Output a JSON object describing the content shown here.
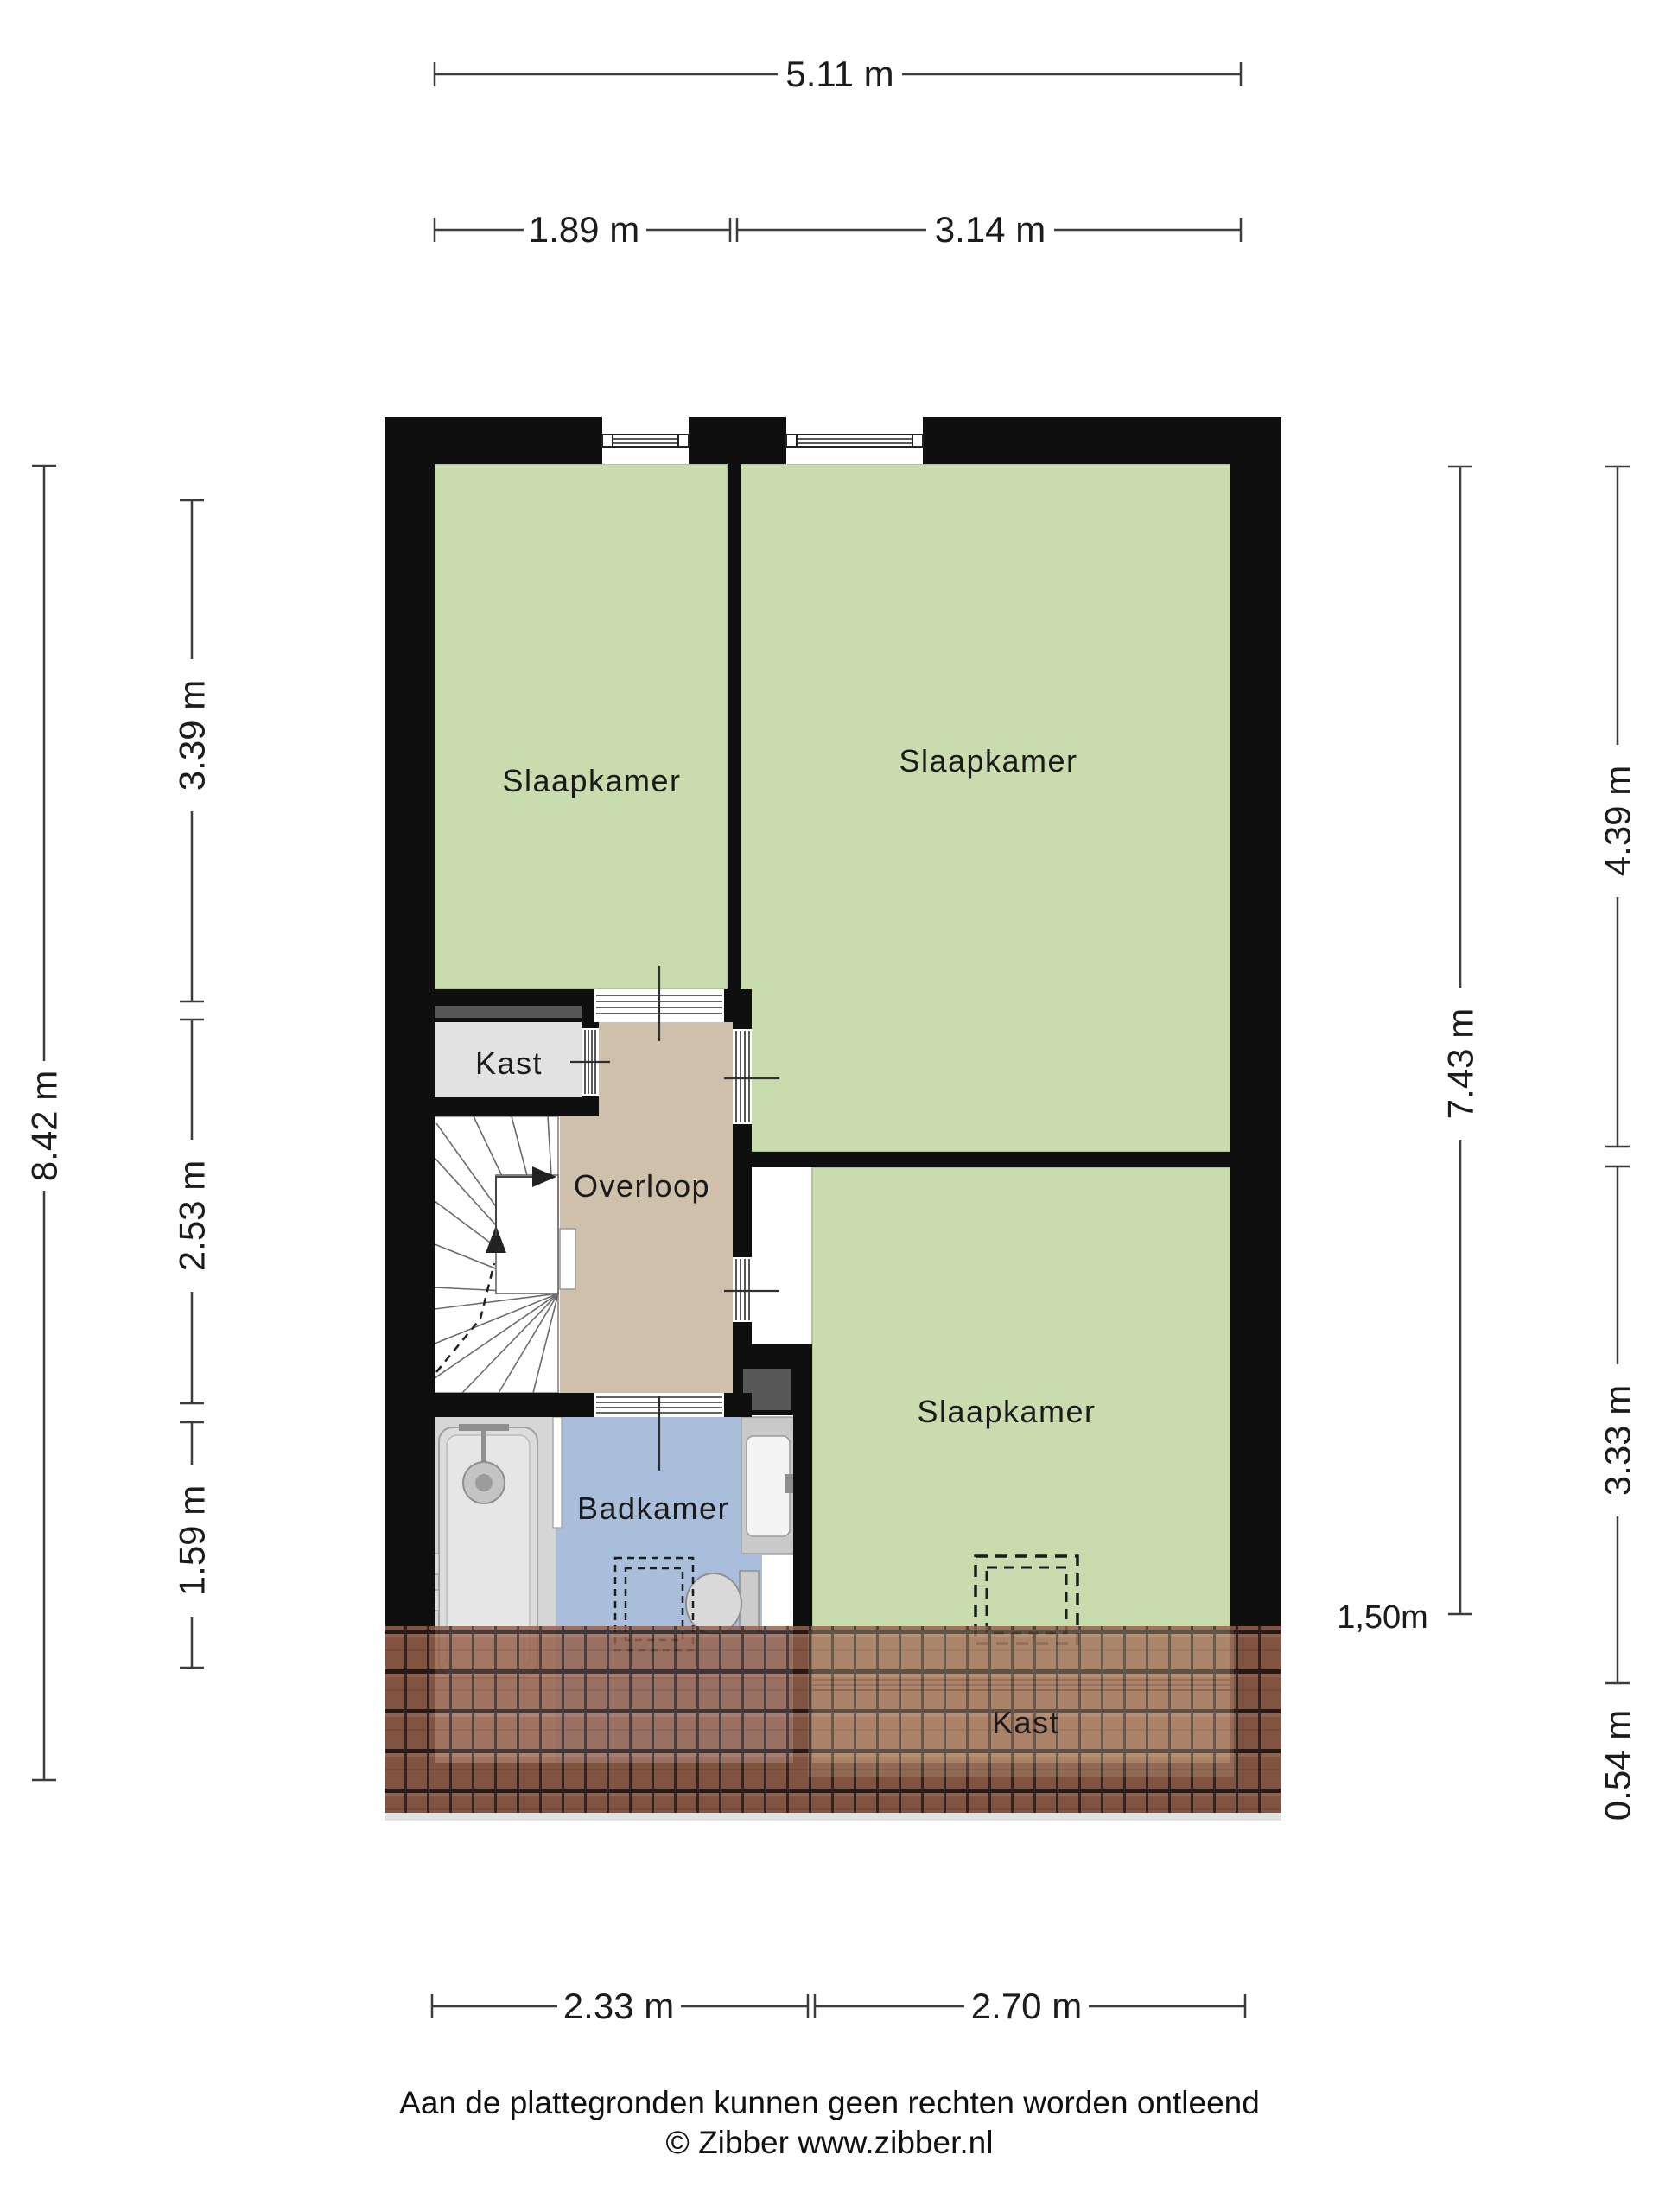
{
  "floor_plan": {
    "rooms": {
      "bedroom_top_left": "Slaapkamer",
      "bedroom_top_right": "Slaapkamer",
      "bedroom_bottom": "Slaapkamer",
      "closet": "Kast",
      "closet_under_roof": "Kast",
      "landing": "Overloop",
      "bathroom": "Badkamer"
    },
    "dimensions": {
      "top_total": "5.11 m",
      "top_left_segment": "1.89 m",
      "top_right_segment": "3.14 m",
      "left_total": "8.42 m",
      "left_segment_1": "3.39 m",
      "left_segment_2": "2.53 m",
      "left_segment_3": "1.59 m",
      "right_total": "7.43 m",
      "right_segment_1": "4.39 m",
      "right_segment_2": "3.33 m",
      "right_segment_3": "0.54 m",
      "bottom_left_segment": "2.33 m",
      "bottom_right_segment": "2.70 m",
      "knee_wall_height": "1,50m"
    },
    "colors": {
      "room_green": "#c9dcae",
      "landing_tan": "#cec0ab",
      "bathroom_blue": "#a9bedb",
      "closet_gray": "#e2e2e2",
      "wall_black": "#0f0f0f",
      "roof_brown": "#96614b"
    },
    "footer": {
      "disclaimer": "Aan de plattegronden kunnen geen rechten worden ontleend",
      "copyright": "© Zibber www.zibber.nl"
    }
  }
}
